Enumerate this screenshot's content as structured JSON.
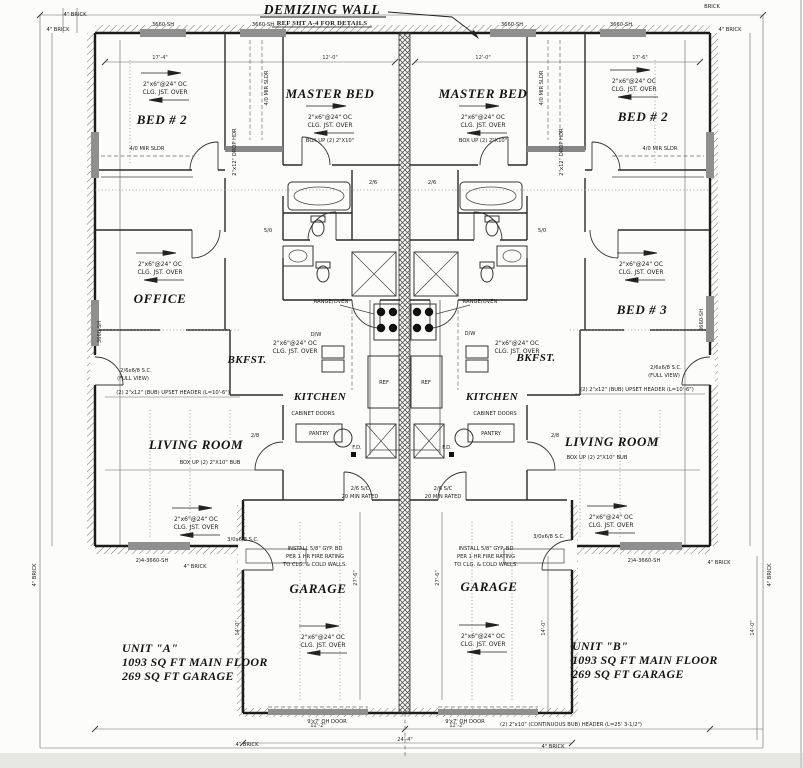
{
  "sheet": {
    "title": {
      "main": "DEMIZING WALL",
      "ref": "REF SHT A-4 FOR DETAILS"
    },
    "rooms": {
      "master_bed": "MASTER BED",
      "bed2": "BED # 2",
      "bed3": "BED # 3",
      "office": "OFFICE",
      "bkfst": "BKFST.",
      "kitchen": "KITCHEN",
      "living": "LIVING ROOM",
      "garage": "GARAGE"
    },
    "units": {
      "a": {
        "name": "UNIT \"A\"",
        "main_floor": "1093 SQ FT MAIN FLOOR",
        "garage": "269 SQ FT GARAGE"
      },
      "b": {
        "name": "UNIT \"B\"",
        "main_floor": "1093 SQ FT MAIN FLOOR",
        "garage": "269 SQ FT GARAGE"
      }
    },
    "ann": {
      "clg1": "2\"x6\"@24\" OC",
      "clg2": "CLG. JST. OVER",
      "box_up_short": "BOX UP (2) 2\"X10\"",
      "box_up_bub": "BOX UP (2) 2\"X10\" BUB",
      "range_oven": "RANGE/OVEN",
      "ref": "REF",
      "dw": "D/W",
      "pantry": "PANTRY",
      "cabinet_doors": "CABINET DOORS",
      "fd": "F.D.",
      "rated1": "2/6 S/C",
      "rated2": "20 MIN RATED",
      "fire1": "INSTALL 5/8\" GYP. BD",
      "fire2": "PER 1 HR FIRE RATING",
      "fire3": "TO CLG. & COLD WALLS.",
      "oh_door": "9'x7' OH DOOR",
      "cont_header": "(2) 2\"x10\" (CONTINUOUS BUB) HEADER (L=25' 3-1/2\")",
      "upset_header": "(2) 2\"x12\" (BUB) UPSET HEADER (L=10'-6\")",
      "sc_full1": "2/6x6/8 S.C.",
      "sc_full2": "(FULL VIEW)",
      "sc_door": "3/0x6/8 S.C.",
      "mir_sldr": "4/0 MIR SLDR",
      "drop_hdr": "2\"x12\" DROP HDR",
      "brick": "4\" BRICK",
      "brick_short": "BRICK",
      "win_sh": "3660-SH",
      "win_2sh": "2)4-3660-SH",
      "d26": "2/6",
      "d50": "5/0",
      "d28": "2/8"
    },
    "dims": {
      "bed2a_w": "17'-4\"",
      "master_w": "12'-0\"",
      "bed2b_w": "17'-6\"",
      "garage_depth": "27'-6\"",
      "yard": "14'-0\"",
      "oh_span": "12'-2\"",
      "garage_front": "24'-4\""
    }
  }
}
